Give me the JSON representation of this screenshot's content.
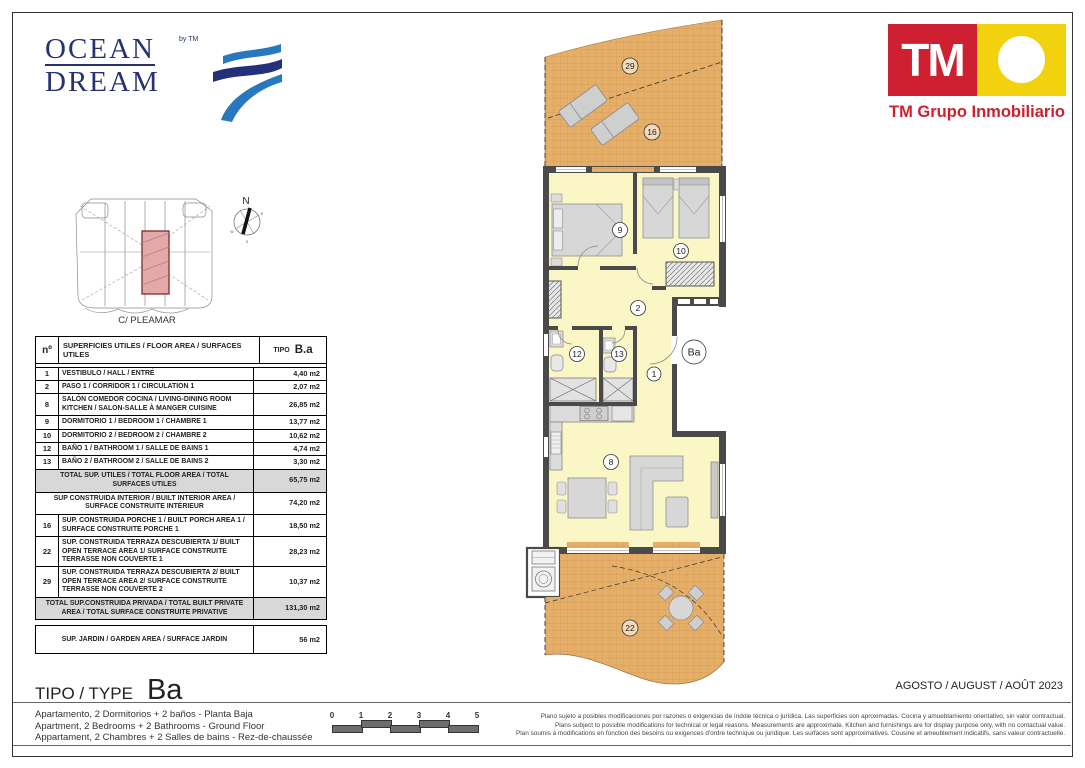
{
  "branding": {
    "ocean_dream": {
      "word1": "OCEAN",
      "word2": "DREAM",
      "by": "by TM",
      "navy": "#283273",
      "wave_blue": "#2878BE"
    },
    "tm": {
      "initials": "TM",
      "company": "TM Grupo Inmobiliario",
      "red": "#CE2030",
      "yellow": "#F2D10E"
    }
  },
  "site_plan": {
    "street": "C/ PLEAMAR",
    "compass": {
      "n": "N",
      "e": "e",
      "s": "s",
      "w": "w"
    },
    "highlight_color": "#E3A9A9"
  },
  "area_table": {
    "header": {
      "col_num": "nº",
      "col_desc": "SUPERFICIES UTILES / FLOOR AREA / SURFACES UTILES",
      "col_tipo": "TIPO",
      "col_type": "B.a"
    },
    "rows": [
      {
        "num": "1",
        "desc": "VESTIBULO / HALL / ENTRÉ",
        "value": "4,40 m2"
      },
      {
        "num": "2",
        "desc": "PASO 1 / CORRIDOR 1 / CIRCULATION 1",
        "value": "2,07 m2"
      },
      {
        "num": "8",
        "desc": "SALÓN COMEDOR COCINA / LIVING-DINING ROOM KITCHEN / SALON-SALLE À MANGER CUISINE",
        "value": "26,85 m2"
      },
      {
        "num": "9",
        "desc": "DORMITORIO 1 / BEDROOM 1 / CHAMBRE 1",
        "value": "13,77 m2"
      },
      {
        "num": "10",
        "desc": "DORMITORIO 2 / BEDROOM 2 / CHAMBRE 2",
        "value": "10,62 m2"
      },
      {
        "num": "12",
        "desc": "BAÑO 1 / BATHROOM 1 / SALLE DE BAINS 1",
        "value": "4,74 m2"
      },
      {
        "num": "13",
        "desc": "BAÑO 2 / BATHROOM 2 / SALLE DE BAINS 2",
        "value": "3,30 m2"
      }
    ],
    "summary": [
      {
        "desc": "TOTAL SUP. UTILES / TOTAL FLOOR AREA / TOTAL SURFACES UTILES",
        "value": "65,75 m2",
        "shaded": true
      },
      {
        "desc": "SUP CONSTRUIDA INTERIOR / BUILT INTERIOR AREA / SURFACE CONSTRUITE INTÉRIEUR",
        "value": "74,20 m2",
        "shaded": false
      },
      {
        "num": "16",
        "desc": "SUP. CONSTRUIDA PORCHE 1 / BUILT PORCH AREA 1 / SURFACE CONSTRUITE PORCHE 1",
        "value": "18,50 m2",
        "shaded": false
      },
      {
        "num": "22",
        "desc": "SUP. CONSTRUIDA TERRAZA DESCUBIERTA 1/ BUILT OPEN TERRACE AREA 1/  SURFACE CONSTRUITE TERRASSE NON COUVERTE 1",
        "value": "28,23 m2",
        "shaded": false
      },
      {
        "num": "29",
        "desc": "SUP. CONSTRUIDA TERRAZA DESCUBIERTA 2/ BUILT OPEN TERRACE AREA 2/  SURFACE CONSTRUITE TERRASSE NON COUVERTE 2",
        "value": "10,37 m2",
        "shaded": false
      },
      {
        "desc": "TOTAL SUP.CONSTRUIDA PRIVADA / TOTAL  BUILT PRIVATE AREA / TOTAL SURFACE CONSTRUITE PRIVATIVE",
        "value": "131,30 m2",
        "shaded": true
      }
    ],
    "jardin": {
      "desc": "SUP. JARDIN / GARDEN AREA  / SURFACE JARDIN",
      "value": "56 m2"
    }
  },
  "floor_plan": {
    "labels": {
      "t29": "29",
      "t16": "16",
      "r9": "9",
      "r10": "10",
      "c2": "2",
      "b12": "12",
      "b13": "13",
      "h1": "1",
      "ba": "Ba",
      "l8": "8",
      "t22": "22"
    },
    "colors": {
      "terrace": "#E6AF69",
      "room": "#FAF6C5",
      "wall": "#4A4A4A"
    }
  },
  "footer": {
    "tipo_label": "TIPO / TYPE",
    "type_code": "Ba",
    "date": "AGOSTO / AUGUST / AOÛT  2023",
    "description": [
      "Apartamento, 2 Dormitorios + 2 baños - Planta Baja",
      "Apartment, 2 Bedrooms + 2 Bathrooms - Ground Floor",
      "Appartament, 2 Chambres + 2 Salles de bains - Rez-de-chaussée"
    ],
    "scale_marks": [
      "0",
      "1",
      "2",
      "3",
      "4",
      "5"
    ],
    "disclaimer": [
      "Plano sujeto a posibles modificaciones por razones o exigencias de índole técnica o jurídica. Las superficies son aproximadas. Cocina y amueblamiento orientativo, sin valor contractual.",
      "Plans subject to possible modifications for technical or legal reasons. Measurements are approximate. Kitchen and furnishings are for display purpose only, with no contactual value.",
      "Plan soumis à modifications en fonction des besoins ou exigences d'ordre technique ou juridique. Les surfaces sont approximatives. Cousine et ameublement indicatifs, sans valeur contractuelle."
    ]
  }
}
